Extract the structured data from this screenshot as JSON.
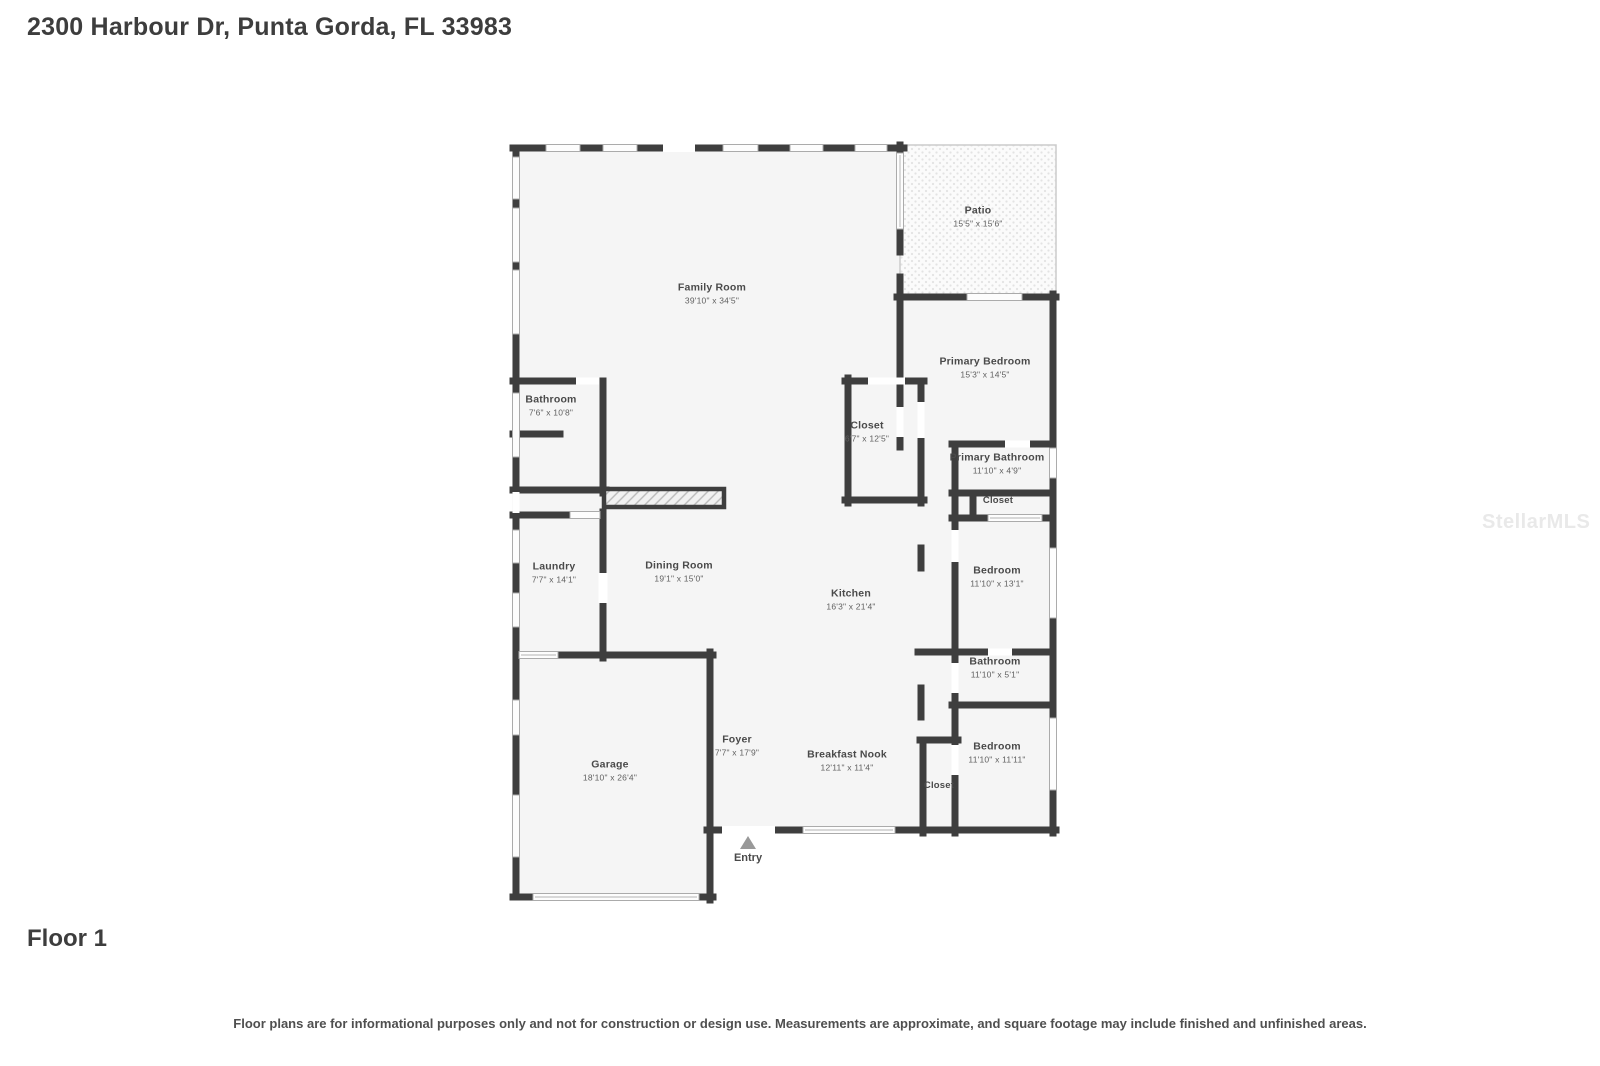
{
  "page": {
    "title": "2300 Harbour Dr, Punta Gorda, FL 33983",
    "floor_label": "Floor 1",
    "disclaimer": "Floor plans are for informational purposes only and not for construction or design use. Measurements are approximate, and square footage may include finished and unfinished areas.",
    "watermark": "StellarMLS"
  },
  "floor_plan": {
    "entry_label": "Entry",
    "colors": {
      "wall": "#3e3e3e",
      "floor": "#f5f5f5",
      "window_outline": "#ababab",
      "patio_dot": "#e3e3e3",
      "entry_arrow": "#999999"
    },
    "rooms": [
      {
        "name": "Family Room",
        "dims": "39'10\" x 34'5\""
      },
      {
        "name": "Patio",
        "dims": "15'5\" x 15'6\""
      },
      {
        "name": "Primary Bedroom",
        "dims": "15'3\" x 14'5\""
      },
      {
        "name": "Bathroom",
        "dims": "7'6\" x 10'8\""
      },
      {
        "name": "Closet",
        "dims": "6'7\" x 12'5\""
      },
      {
        "name": "Primary Bathroom",
        "dims": "11'10\" x 4'9\""
      },
      {
        "name": "Closet",
        "dims": ""
      },
      {
        "name": "Laundry",
        "dims": "7'7\" x 14'1\""
      },
      {
        "name": "Dining Room",
        "dims": "19'1\" x 15'0\""
      },
      {
        "name": "Kitchen",
        "dims": "16'3\" x 21'4\""
      },
      {
        "name": "Bedroom",
        "dims": "11'10\" x 13'1\""
      },
      {
        "name": "Bathroom",
        "dims": "11'10\" x 5'1\""
      },
      {
        "name": "Bedroom",
        "dims": "11'10\" x 11'11\""
      },
      {
        "name": "Garage",
        "dims": "18'10\" x 26'4\""
      },
      {
        "name": "Foyer",
        "dims": "7'7\" x 17'9\""
      },
      {
        "name": "Breakfast Nook",
        "dims": "12'11\" x 11'4\""
      },
      {
        "name": "Closet",
        "dims": ""
      }
    ]
  }
}
